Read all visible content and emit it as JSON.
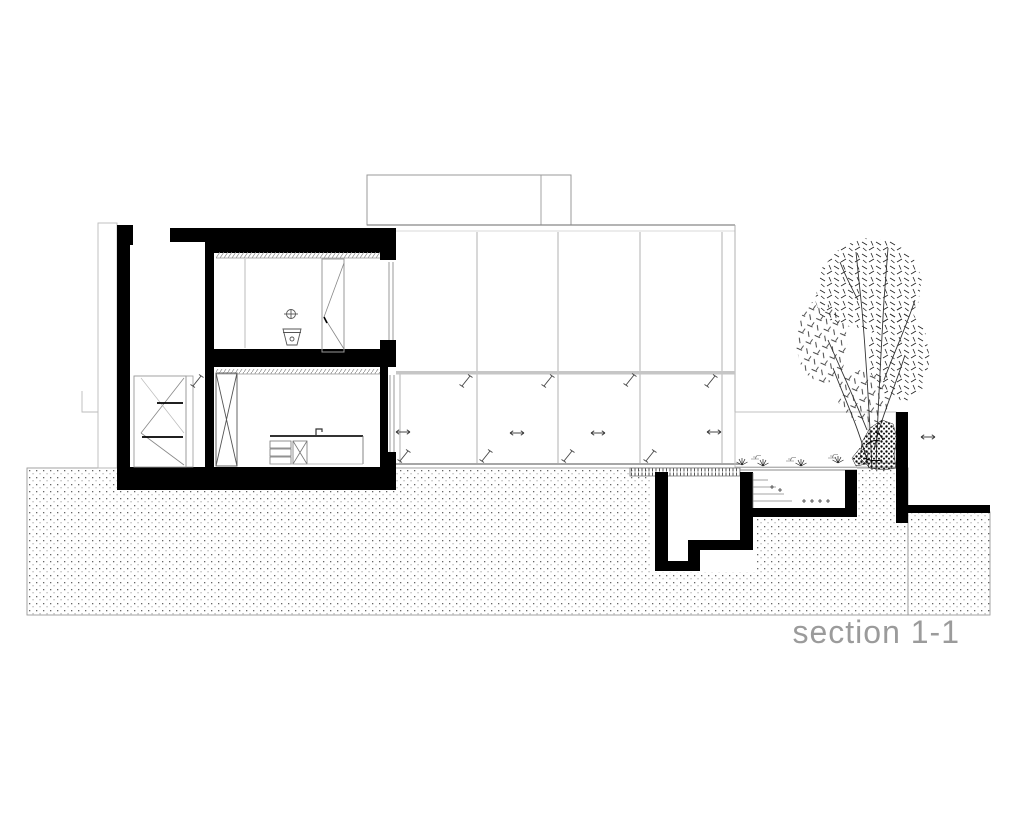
{
  "drawing": {
    "title": "section 1-1"
  },
  "colors": {
    "paper": "#ffffff",
    "cut_black": "#000000",
    "elevation_gray": "#9a9a9a",
    "title_gray": "#9b9b9b"
  },
  "symbols": {
    "sliding_arrow": "double-headed horizontal arrow on sliding glass panels",
    "glazing_slash": "diagonal glass indicator slash",
    "grass_tuft": "small plant symbol at grade",
    "tree": "birch tree in elevation",
    "shrub": "dense shrub at tree base"
  }
}
